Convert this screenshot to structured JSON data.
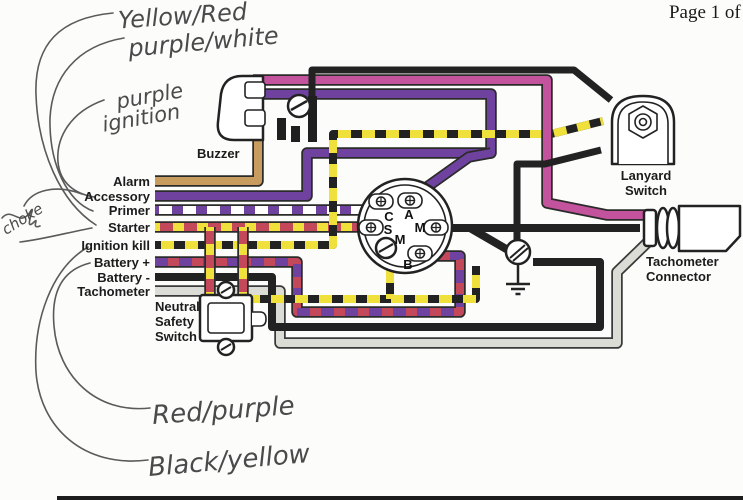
{
  "page": {
    "label": "Page 1 of 1"
  },
  "handwritten": {
    "top_note_1": "Yellow/Red",
    "top_note_2": "purple/white",
    "mid_note_line1": "purple",
    "mid_note_line2": "ignition",
    "left_scribble": "choke",
    "bottom_note_1": "Red/purple",
    "bottom_note_2": "Black/yellow"
  },
  "harness": {
    "labels": [
      "Alarm",
      "Accessory",
      "Primer",
      "Starter",
      "Ignition kill",
      "Battery +",
      "Battery -",
      "Tachometer"
    ]
  },
  "components": {
    "buzzer": "Buzzer",
    "lanyard_switch": "Lanyard Switch",
    "tachometer_connector_line1": "Tachometer",
    "tachometer_connector_line2": "Connector",
    "neutral_safety_switch_line1": "Neutral",
    "neutral_safety_switch_line2": "Safety",
    "neutral_safety_switch_line3": "Switch",
    "ignition_terminals": [
      "C",
      "A",
      "S",
      "M",
      "M",
      "B"
    ]
  },
  "wire_colors": {
    "tan": "#c79c5e",
    "purple": "#6f42a0",
    "magenta": "#c4539d",
    "yellow": "#f0e03c",
    "red": "#c2485a",
    "black": "#222222",
    "gray": "#dcdcd6",
    "white": "#ffffff",
    "outline": "#2b2b2b",
    "gray_outline": "#3a3a3a"
  }
}
